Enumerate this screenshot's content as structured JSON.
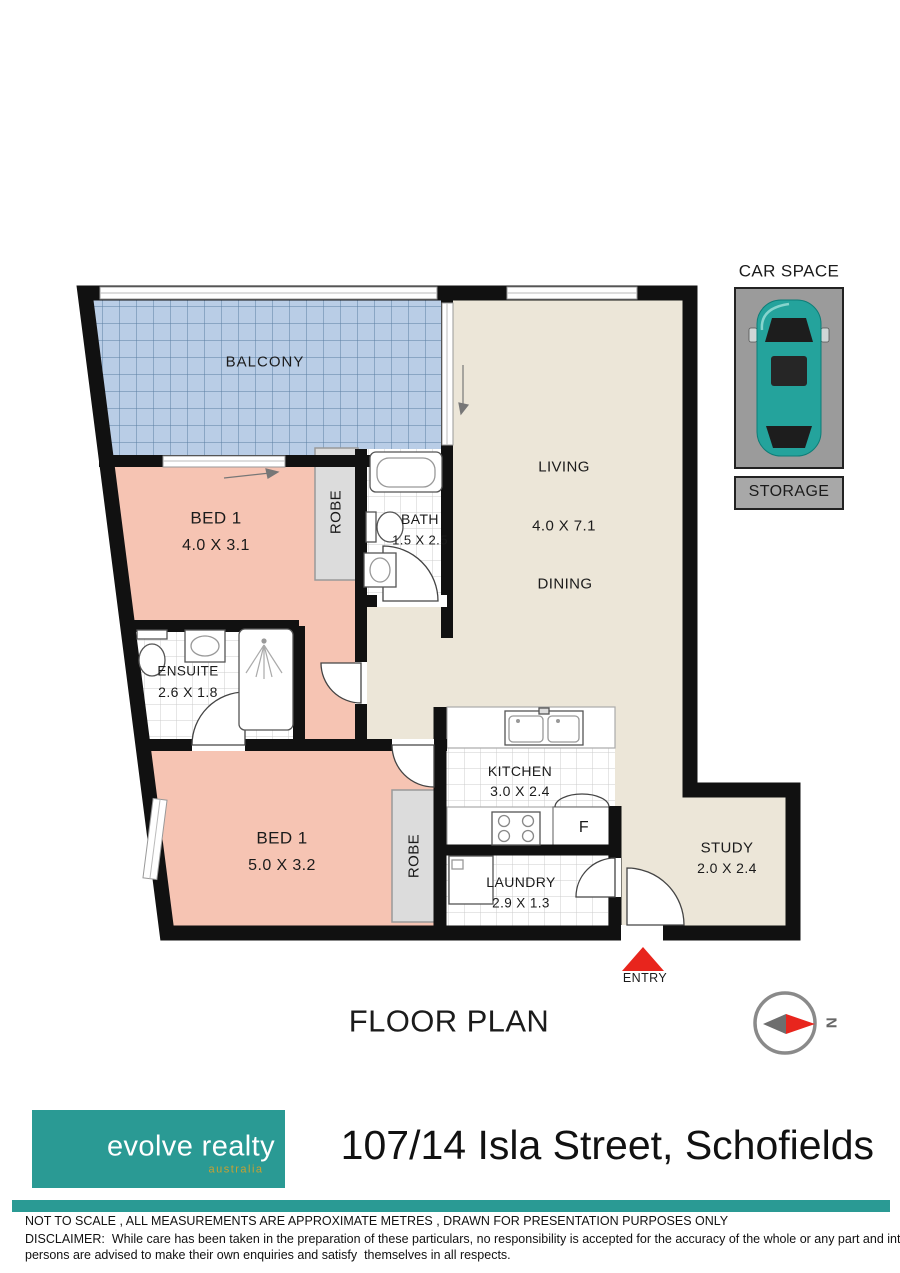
{
  "plan": {
    "title": "FLOOR PLAN",
    "compass_label": "N",
    "entry_label": "ENTRY",
    "rooms": {
      "balcony": {
        "label": "BALCONY"
      },
      "bed1_top": {
        "label": "BED 1",
        "dims": "4.0 X 3.1"
      },
      "robe_top": {
        "label": "ROBE"
      },
      "bath": {
        "label": "BATH",
        "dims": "1.5 X 2.5"
      },
      "living": {
        "label": "LIVING",
        "dims": "4.0 X 7.1"
      },
      "dining": {
        "label": "DINING"
      },
      "ensuite": {
        "label": "ENSUITE",
        "dims": "2.6 X 1.8"
      },
      "bed1_bottom": {
        "label": "BED 1",
        "dims": "5.0 X 3.2"
      },
      "robe_bottom": {
        "label": "ROBE"
      },
      "kitchen": {
        "label": "KITCHEN",
        "dims": "3.0 X 2.4"
      },
      "fridge": {
        "label": "F"
      },
      "laundry": {
        "label": "LAUNDRY",
        "dims": "2.9 X 1.3"
      },
      "study": {
        "label": "STUDY",
        "dims": "2.0 X 2.4"
      }
    }
  },
  "car_space": {
    "title": "CAR SPACE",
    "storage_label": "STORAGE"
  },
  "footer": {
    "logo": {
      "name": "evolve realty",
      "country": "australia"
    },
    "address": "107/14 Isla Street, Schofields",
    "disclaimer": {
      "line1": "NOT TO SCALE , ALL MEASUREMENTS ARE APPROXIMATE METRES , DRAWN FOR PRESENTATION PURPOSES ONLY",
      "line2": "DISCLAIMER:  While care has been taken in the preparation of these particulars, no responsibility is accepted for the accuracy of the whole or any part and interested",
      "line3": "persons are advised to make their own enquiries and satisfy  themselves in all respects."
    }
  },
  "colors": {
    "wall": "#111111",
    "bedroom_pink": "#f6c4b3",
    "living_beige": "#ece6d8",
    "balcony_blue": "#b9cde6",
    "balcony_grid": "#5b7ea3",
    "robe_gray": "#dcdcdc",
    "carspace_gray": "#9b9b9b",
    "car_teal": "#24a39c",
    "entry_red": "#e8251d",
    "brand_teal": "#2a9a94",
    "brand_gold": "#c8a032"
  }
}
